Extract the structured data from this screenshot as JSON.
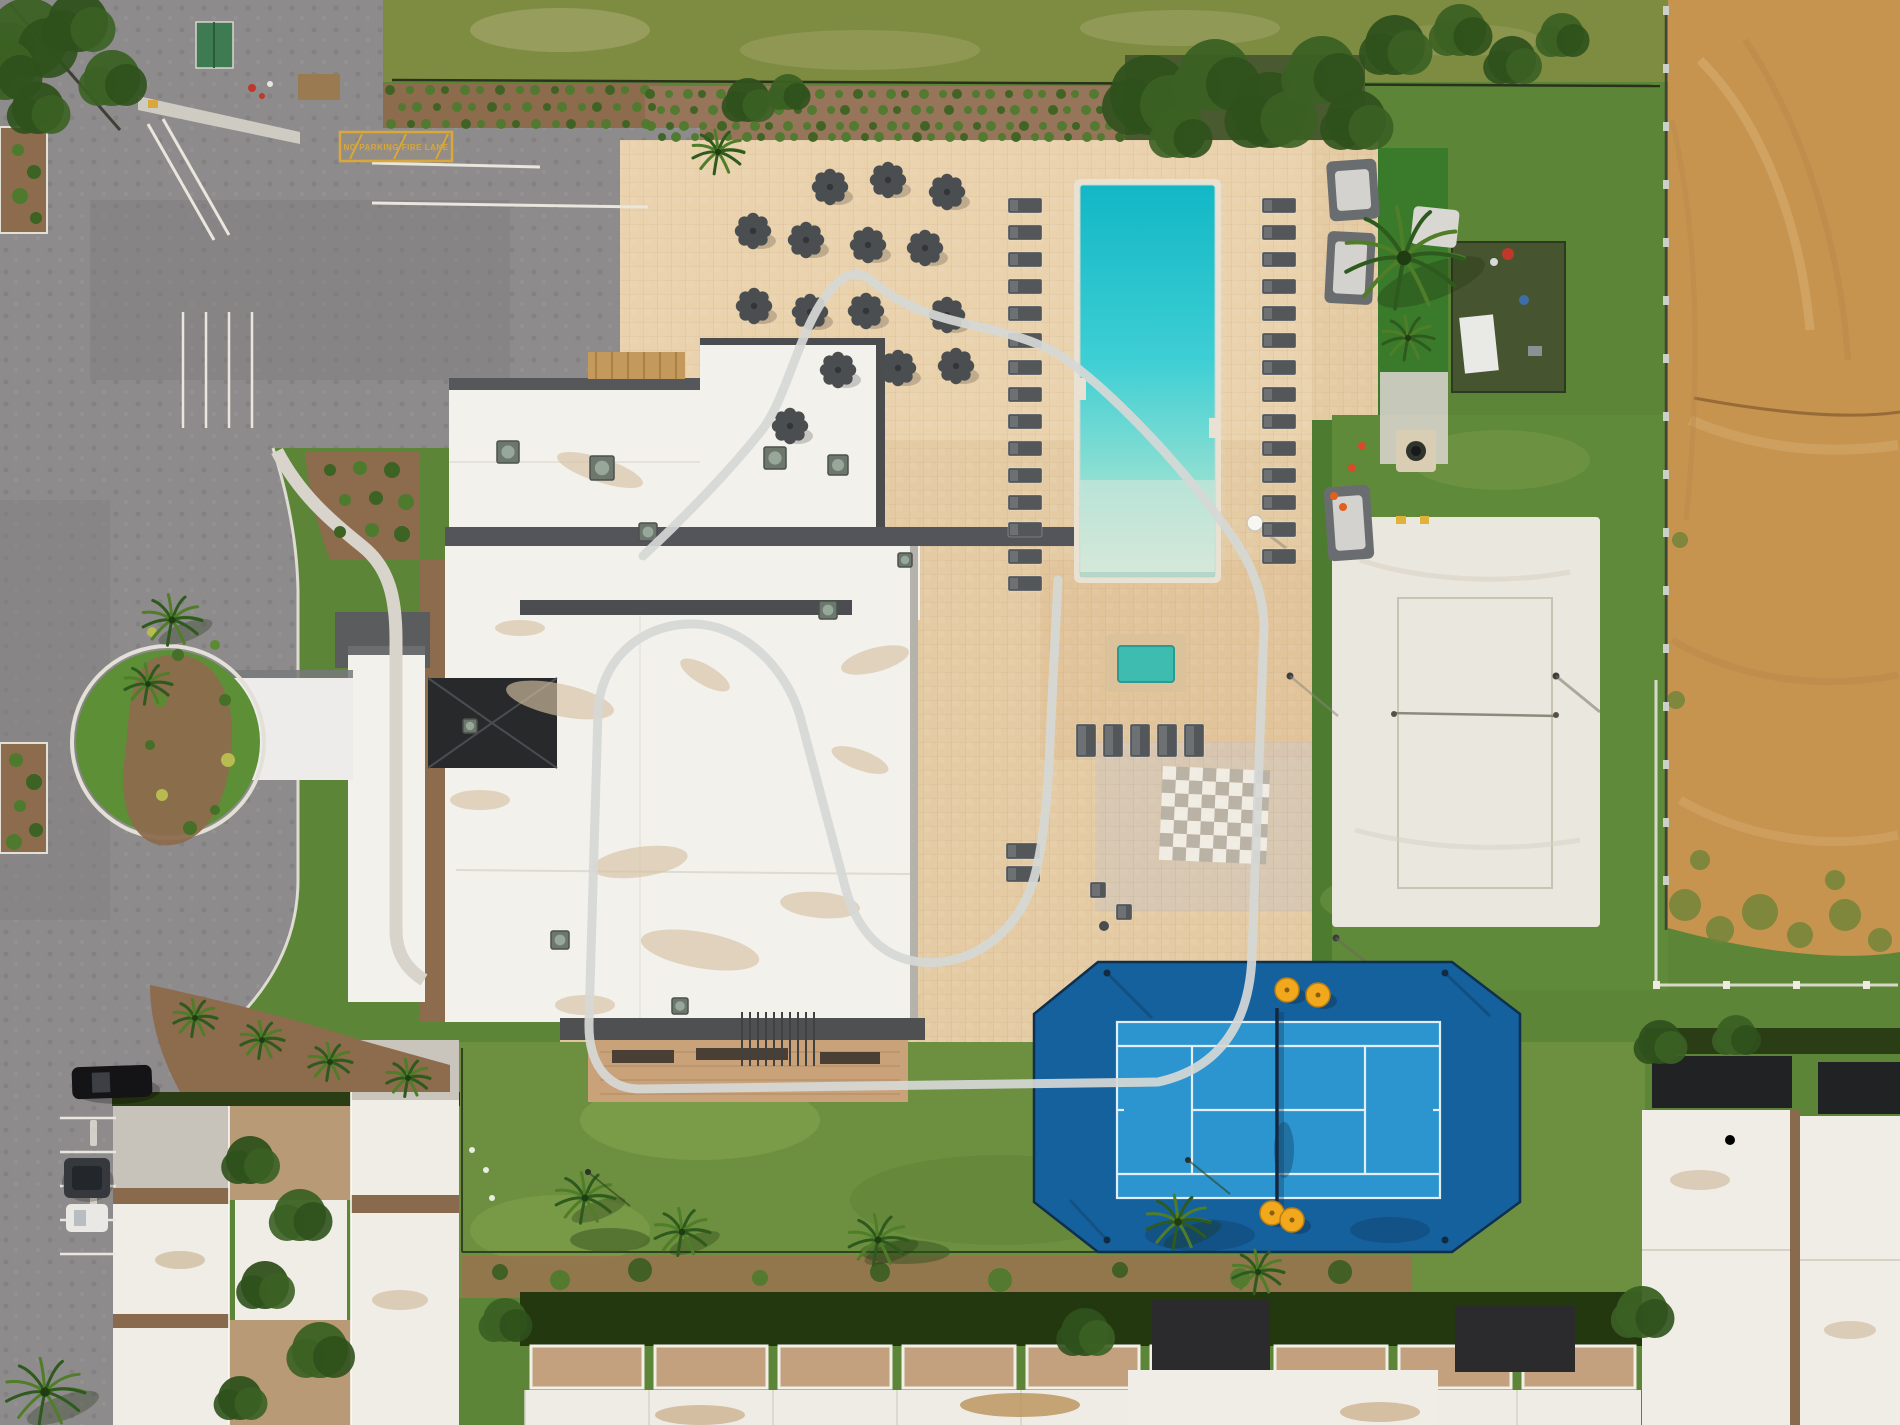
{
  "meta": {
    "image_kind": "aerial-drone-photo",
    "scene_label": "resort-clubhouse-amenities-aerial-view"
  },
  "palette": {
    "asphalt": "#8e8b8c",
    "asphalt_dark": "#7b787a",
    "deck": "#e5cba4",
    "deck_light": "#efd9b4",
    "deck_pink": "#dfbd92",
    "plaza_gray": "#d3c6b5",
    "lawn_top": "#7e8c42",
    "grass": "#5c8537",
    "south_lawn": "#6d9040",
    "turf": "#3a7a2b",
    "pool_deep": "#12b7c6",
    "pool_mid": "#3ecfd4",
    "pool_beach": "#d4e9d9",
    "spa_water": "#3fbcb0",
    "tennis_outer": "#15619e",
    "tennis_inner": "#2c94ce",
    "court_line": "#eef4f8",
    "volleyball_sand": "#eae7de",
    "dirt": "#c6944f",
    "dirt_light": "#d9b177",
    "dirt_dark": "#b5854a",
    "roof_white": "#f3f1ec",
    "roof_gray": "#c7c3bb",
    "roof_band": "#4b4d50",
    "atrium_dark": "#27292b",
    "hedge": "#24380f",
    "shrub": "#4e7a2e",
    "mulch": "#8c6c4d",
    "umbrella": "#4b4e50",
    "lounger": "#54575a",
    "cabana": "#6a6d70",
    "curb": "#e9e6de",
    "sidewalk": "#d8d4cb",
    "yellow_marking": "#d9a73a",
    "overlay": "#d6d8d6",
    "pergola_wood": "#c49a5c",
    "patio_tan": "#c3a17e",
    "townhouse_roof": "#efece6",
    "garage_black": "#212224",
    "checker_light": "#f1eee6",
    "checker_dark": "#b7b1a4",
    "umbrella_yellow": "#f2a81d",
    "cone_red": "#d84b28",
    "cone_orange": "#e2601f"
  },
  "markings": {
    "fire_lane_text": "NO PARKING  FIRE LANE"
  },
  "scene": {
    "pool": {
      "x": 1080,
      "y": 185,
      "w": 135,
      "h": 392
    },
    "spa": {
      "x": 1118,
      "y": 646,
      "w": 56,
      "h": 36
    },
    "umbrellas": [
      [
        830,
        187
      ],
      [
        888,
        180
      ],
      [
        947,
        192
      ],
      [
        753,
        231
      ],
      [
        806,
        240
      ],
      [
        868,
        245
      ],
      [
        925,
        248
      ],
      [
        754,
        306
      ],
      [
        810,
        312
      ],
      [
        866,
        311
      ],
      [
        947,
        315
      ],
      [
        838,
        370
      ],
      [
        898,
        368
      ],
      [
        956,
        366
      ],
      [
        790,
        426
      ]
    ],
    "loungers": {
      "left_col": {
        "x": 1008,
        "y0": 198,
        "dy": 27,
        "n": 15,
        "w": 34,
        "h": 15
      },
      "right_col": {
        "x": 1262,
        "y0": 198,
        "dy": 27,
        "n": 14,
        "w": 34,
        "h": 15
      },
      "south_row": {
        "x0": 1076,
        "dx": 27,
        "y": 724,
        "n": 5,
        "w": 20,
        "h": 33
      },
      "pair_by_building": [
        [
          1006,
          843
        ],
        [
          1006,
          866
        ]
      ],
      "patio_chairs": [
        [
          1090,
          882
        ],
        [
          1116,
          904
        ]
      ]
    },
    "cabanas": [
      [
        1328,
        160,
        50,
        60
      ],
      [
        1326,
        232,
        48,
        72
      ],
      [
        1326,
        486,
        46,
        74
      ]
    ],
    "couch": [
      1412,
      208,
      46,
      38
    ],
    "checkerboard": {
      "x": 1163,
      "y": 766,
      "cols": 8,
      "rows": 7,
      "size": 13.4,
      "angle": 2.5
    },
    "tennis": {
      "inner": {
        "x": 1117,
        "y": 1022,
        "w": 323,
        "h": 176
      },
      "net_x": 1277,
      "umbrellas": [
        [
          1287,
          990
        ],
        [
          1318,
          995
        ],
        [
          1272,
          1213
        ],
        [
          1292,
          1220
        ]
      ],
      "poles": [
        [
          1107,
          973
        ],
        [
          1445,
          973
        ],
        [
          1107,
          1240
        ],
        [
          1445,
          1240
        ]
      ]
    },
    "volleyball": {
      "sand": {
        "x": 1332,
        "y": 517,
        "w": 268,
        "h": 410
      },
      "court": {
        "x": 1398,
        "y": 598,
        "w": 154,
        "h": 290
      },
      "net_y": 713
    },
    "palms": [
      [
        1404,
        258,
        60
      ],
      [
        1408,
        338,
        26
      ],
      [
        718,
        152,
        26
      ],
      [
        172,
        620,
        30
      ],
      [
        148,
        684,
        24
      ],
      [
        585,
        1198,
        30
      ],
      [
        682,
        1232,
        28
      ],
      [
        878,
        1240,
        30
      ],
      [
        1178,
        1222,
        32
      ],
      [
        1258,
        1272,
        26
      ],
      [
        195,
        1018,
        22
      ],
      [
        262,
        1040,
        22
      ],
      [
        330,
        1062,
        22
      ],
      [
        408,
        1078,
        22
      ],
      [
        45,
        1392,
        40
      ]
    ],
    "trees": [
      [
        28,
        38,
        40
      ],
      [
        78,
        22,
        30
      ],
      [
        112,
        78,
        28
      ],
      [
        38,
        108,
        26
      ],
      [
        5,
        70,
        30
      ],
      [
        1150,
        95,
        40
      ],
      [
        1215,
        75,
        36
      ],
      [
        1270,
        110,
        38
      ],
      [
        1322,
        70,
        34
      ],
      [
        1356,
        120,
        30
      ],
      [
        1180,
        132,
        26
      ],
      [
        1395,
        45,
        30
      ],
      [
        1460,
        30,
        26
      ],
      [
        1512,
        60,
        24
      ],
      [
        1562,
        35,
        22
      ],
      [
        748,
        100,
        22
      ],
      [
        788,
        92,
        18
      ],
      [
        250,
        1160,
        24
      ],
      [
        300,
        1215,
        26
      ],
      [
        265,
        1285,
        24
      ],
      [
        320,
        1350,
        28
      ],
      [
        240,
        1398,
        22
      ],
      [
        505,
        1320,
        22
      ],
      [
        1085,
        1332,
        24
      ],
      [
        1642,
        1312,
        26
      ],
      [
        1660,
        1042,
        22
      ],
      [
        1736,
        1035,
        20
      ]
    ],
    "shrub_grids": [
      {
        "x0": 392,
        "y0": 92,
        "cols": 15,
        "rows": 3,
        "dx": 18,
        "dy": 15,
        "r": 5,
        "stagger": 9
      },
      {
        "x0": 652,
        "y0": 96,
        "cols": 28,
        "rows": 4,
        "dx": 17,
        "dy": 14,
        "r": 5,
        "stagger": 8
      }
    ],
    "bed_shrubs": [
      [
        330,
        470
      ],
      [
        360,
        468
      ],
      [
        392,
        470
      ],
      [
        345,
        500
      ],
      [
        376,
        498
      ],
      [
        406,
        502
      ],
      [
        340,
        532
      ],
      [
        372,
        530
      ],
      [
        402,
        534
      ],
      [
        18,
        150
      ],
      [
        34,
        172
      ],
      [
        20,
        196
      ],
      [
        36,
        218
      ],
      [
        16,
        760
      ],
      [
        34,
        782
      ],
      [
        20,
        806
      ],
      [
        36,
        830
      ],
      [
        14,
        842
      ]
    ],
    "island_shrubs": [
      [
        152,
        632
      ],
      [
        178,
        655
      ],
      [
        160,
        700
      ],
      [
        150,
        745
      ],
      [
        162,
        795
      ],
      [
        190,
        828
      ],
      [
        215,
        645
      ],
      [
        225,
        700
      ],
      [
        228,
        760
      ],
      [
        215,
        810
      ]
    ],
    "ac_units": [
      [
        508,
        452,
        22
      ],
      [
        602,
        468,
        24
      ],
      [
        648,
        532,
        18
      ],
      [
        775,
        458,
        22
      ],
      [
        838,
        465,
        20
      ],
      [
        828,
        610,
        18
      ],
      [
        560,
        940,
        18
      ],
      [
        680,
        1006,
        16
      ],
      [
        470,
        726,
        14
      ],
      [
        905,
        560,
        14
      ]
    ],
    "roof_stains": [
      [
        600,
        470,
        45,
        12,
        18
      ],
      [
        560,
        700,
        55,
        16,
        12
      ],
      [
        640,
        862,
        48,
        15,
        -8
      ],
      [
        705,
        675,
        28,
        10,
        30
      ],
      [
        820,
        905,
        40,
        13,
        5
      ],
      [
        875,
        660,
        35,
        12,
        -15
      ],
      [
        480,
        800,
        30,
        10,
        0
      ],
      [
        700,
        950,
        60,
        18,
        10
      ],
      [
        520,
        628,
        25,
        8,
        0
      ],
      [
        860,
        760,
        30,
        10,
        20
      ],
      [
        585,
        1005,
        30,
        10,
        0
      ]
    ],
    "cars": {
      "parallel_black": [
        72,
        1066,
        80,
        32
      ],
      "suv_dark": [
        64,
        1158,
        46,
        40
      ],
      "sedan_white": [
        66,
        1204,
        42,
        28
      ]
    },
    "stall_lines_y": [
      1118,
      1152,
      1186,
      1220,
      1254
    ],
    "parking_stall_xs": [
      183,
      206,
      229,
      252
    ],
    "cones_red": [
      [
        1352,
        468
      ],
      [
        1362,
        446
      ]
    ],
    "cones_orange": [
      [
        1334,
        496
      ],
      [
        1343,
        507
      ]
    ],
    "fences": {
      "dirt_line": {
        "x": 1666,
        "y0": 6,
        "y1": 930,
        "post_dy": 58
      },
      "vb_east": {
        "x": 1656,
        "y0": 680,
        "y1": 985
      },
      "vb_south": {
        "y": 985,
        "x0": 1656,
        "x1": 1898,
        "post_dx": 70
      }
    },
    "lawn_poles": [
      [
        588,
        1172
      ],
      [
        1188,
        1160
      ]
    ],
    "survey_dots": [
      [
        486,
        1170
      ],
      [
        492,
        1198
      ],
      [
        472,
        1150
      ]
    ],
    "mulch_blobs": [
      [
        500,
        1272
      ],
      [
        560,
        1280
      ],
      [
        640,
        1270
      ],
      [
        760,
        1278
      ],
      [
        880,
        1272
      ],
      [
        1000,
        1280
      ],
      [
        1120,
        1270
      ],
      [
        1240,
        1278
      ],
      [
        1340,
        1272
      ]
    ],
    "weeds": [
      [
        1685,
        905,
        16
      ],
      [
        1720,
        930,
        14
      ],
      [
        1760,
        912,
        18
      ],
      [
        1800,
        935,
        13
      ],
      [
        1845,
        915,
        16
      ],
      [
        1880,
        940,
        12
      ],
      [
        1700,
        860,
        10
      ],
      [
        1835,
        880,
        10
      ],
      [
        1676,
        700,
        9
      ],
      [
        1680,
        540,
        8
      ]
    ],
    "center_units": {
      "x0": 525,
      "n": 9,
      "dx": 124,
      "wall_y": 1346,
      "roof_y": 1390
    }
  }
}
